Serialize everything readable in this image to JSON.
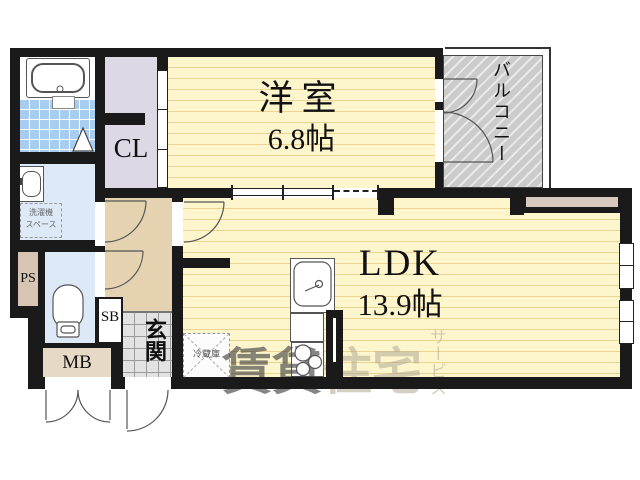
{
  "document": {
    "type": "apartment-floor-plan"
  },
  "rooms": {
    "western_room": {
      "name": "洋室",
      "size": "6.8帖"
    },
    "ldk": {
      "name": "LDK",
      "size": "13.9帖"
    },
    "balcony": {
      "name": "バルコニー"
    },
    "closet": {
      "abbr": "CL"
    },
    "entrance": {
      "name": "玄関"
    },
    "shoe_box": {
      "abbr": "SB"
    },
    "meter_box": {
      "abbr": "MB"
    },
    "pipe_space": {
      "abbr": "PS"
    },
    "washing_machine_space": {
      "line1": "洗濯機",
      "line2": "スペース"
    },
    "refrigerator": {
      "name": "冷蔵庫"
    }
  },
  "watermark": {
    "part1": "賃貸",
    "part2": "住宅",
    "vertical": "サービス"
  },
  "colors": {
    "wall": "#1a1a1a",
    "floor": "#fdf6cd",
    "stripe": "#edd391",
    "hall": "#e4d2b1",
    "closet": "#dcd9e5",
    "balcony": "#cbcbcb",
    "wet": "#dde9f7",
    "tile": "#a9cdf0",
    "mb": "#e6d9c5",
    "ps": "#d5c5b2",
    "genkan": "#e2e2e2",
    "grid": "#9b9b9b",
    "counter": "#d7c9be",
    "wm_dark": "rgba(60,60,60,0.62)",
    "wm_light": "rgba(175,168,150,0.55)"
  }
}
